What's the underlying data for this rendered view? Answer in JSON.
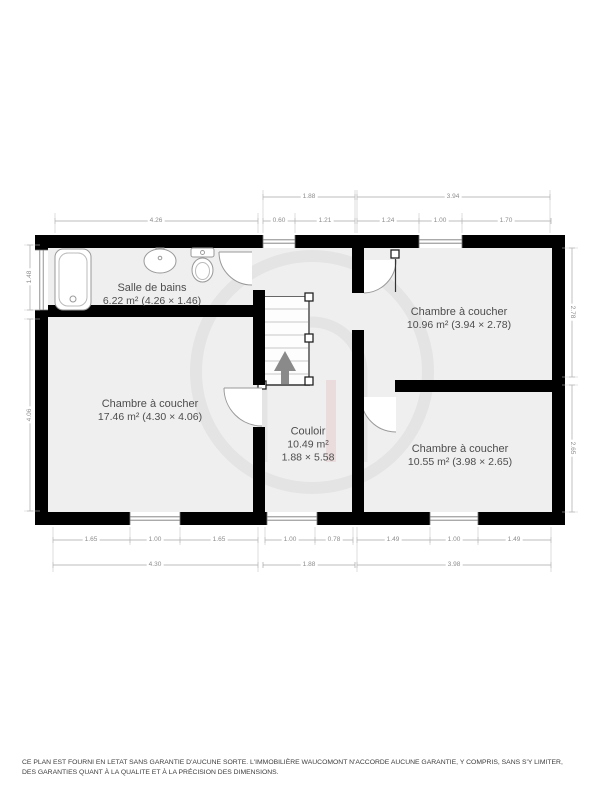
{
  "rooms": {
    "bathroom": {
      "name": "Salle de bains",
      "details": "6.22 m² (4.26 × 1.46)"
    },
    "bedroom_right_top": {
      "name": "Chambre à coucher",
      "details": "10.96 m² (3.94 × 2.78)"
    },
    "bedroom_left": {
      "name": "Chambre à coucher",
      "details": "17.46 m² (4.30 × 4.06)"
    },
    "corridor": {
      "name": "Couloir",
      "area": "10.49 m²",
      "size": "1.88 × 5.58"
    },
    "bedroom_right_bottom": {
      "name": "Chambre à coucher",
      "details": "10.55 m² (3.98 × 2.65)"
    }
  },
  "dimensions": {
    "top_row1": [
      "1.88",
      "3.94"
    ],
    "top_row2": [
      "4.26",
      "0.60",
      "1.21",
      "1.24",
      "1.00",
      "1.70"
    ],
    "bottom_row1": [
      "1.65",
      "1.00",
      "1.65",
      "1.00",
      "0.78",
      "1.49",
      "1.00",
      "1.49"
    ],
    "bottom_row2": [
      "4.30",
      "1.88",
      "3.98"
    ],
    "left": [
      "1.48",
      "4.06"
    ],
    "right": [
      "2.78",
      "2.65"
    ]
  },
  "icons": {
    "stairs_arrow": "up-arrow",
    "fixtures": [
      "bathtub-icon",
      "sink-icon",
      "toilet-icon"
    ]
  },
  "colors": {
    "wall": "#000000",
    "room_fill": "#efefef",
    "dim_text": "#8d8d8d",
    "label_text": "#4d4d4d",
    "watermark": "#e4e4e4",
    "arrow": "#8a8a8a"
  },
  "disclaimer": "CE PLAN EST FOURNI EN LETAT SANS GARANTIE D'AUCUNE SORTE. L'IMMOBILIÈRE WAUCOMONT N'ACCORDE AUCUNE GARANTIE, Y COMPRIS, SANS S'Y LIMITER, DES GARANTIES QUANT À LA QUALITE ET À LA PRÉCISION DES DIMENSIONS."
}
